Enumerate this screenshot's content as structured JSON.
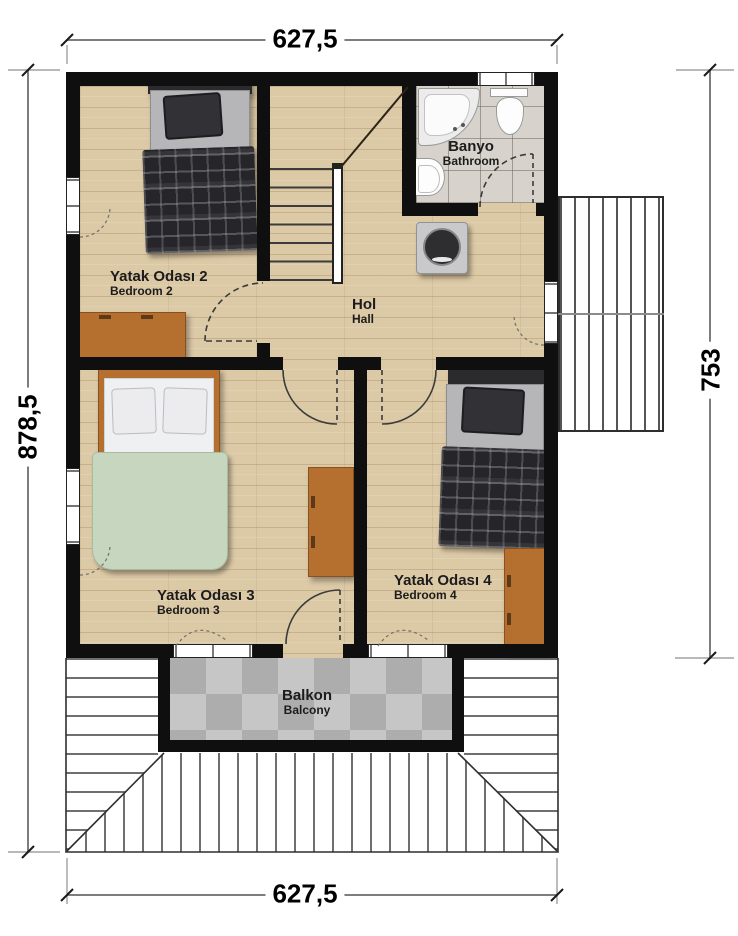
{
  "plan_title": "Upper floor plan",
  "dimensions": {
    "top": "627,5",
    "bottom": "627,5",
    "left": "878,5",
    "right": "753"
  },
  "rooms": {
    "bedroom2": {
      "name": "Yatak Odası 2",
      "name_en": "Bedroom 2"
    },
    "bedroom3": {
      "name": "Yatak Odası 3",
      "name_en": "Bedroom 3"
    },
    "bedroom4": {
      "name": "Yatak Odası 4",
      "name_en": "Bedroom 4"
    },
    "hall": {
      "name": "Hol",
      "name_en": "Hall"
    },
    "bathroom": {
      "name": "Banyo",
      "name_en": "Bathroom"
    },
    "balcony": {
      "name": "Balkon",
      "name_en": "Balcony"
    }
  },
  "symbols": [
    "single-bed",
    "double-bed",
    "dresser",
    "staircase",
    "corner-bathtub",
    "toilet",
    "sink",
    "washing-machine",
    "door-swing",
    "window",
    "roof-hatch"
  ],
  "colors": {
    "wall": "#0f0f0f",
    "wood_floor": "#dcc9a6",
    "bathroom_tile": "#d7d3cc",
    "balcony_tile_dark": "#adadad",
    "balcony_tile_light": "#c6c6c6",
    "furniture_brown": "#b5702f",
    "blanket_green": "#c7d6bf",
    "blanket_plaid": "#26262a",
    "label_text": "#1c1c1c",
    "dimension_line": "#7d7d7d"
  }
}
